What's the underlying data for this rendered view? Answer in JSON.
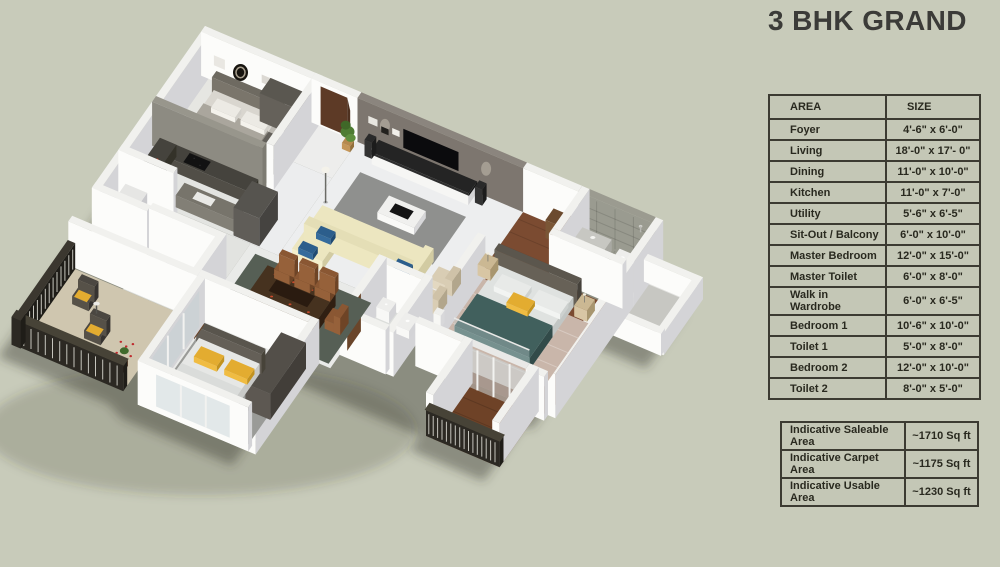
{
  "title": "3 BHK GRAND",
  "areas_table": {
    "headers": {
      "area": "AREA",
      "size": "SIZE"
    },
    "rows": [
      {
        "area": "Foyer",
        "size": "4'-6\" x 6'-0\""
      },
      {
        "area": "Living",
        "size": "18'-0\" x 17'- 0\""
      },
      {
        "area": "Dining",
        "size": "11'-0\" x 10'-0\""
      },
      {
        "area": "Kitchen",
        "size": "11'-0\" x 7'-0\""
      },
      {
        "area": "Utility",
        "size": "5'-6\" x 6'-5\""
      },
      {
        "area": "Sit-Out / Balcony",
        "size": "6'-0\" x 10'-0\""
      },
      {
        "area": "Master Bedroom",
        "size": "12'-0\" x 15'-0\""
      },
      {
        "area": "Master Toilet",
        "size": "6'-0\" x 8'-0\""
      },
      {
        "area": "Walk in Wardrobe",
        "size": "6'-0\" x 6'-5\""
      },
      {
        "area": "Bedroom 1",
        "size": "10'-6\" x 10'-0\""
      },
      {
        "area": "Toilet 1",
        "size": "5'-0\" x 8'-0\""
      },
      {
        "area": "Bedroom 2",
        "size": "12'-0\" x 10'-0\""
      },
      {
        "area": "Toilet 2",
        "size": "8'-0\" x 5'-0\""
      }
    ]
  },
  "summary_table": {
    "rows": [
      {
        "label": "Indicative Saleable Area",
        "value": "~1710 Sq ft"
      },
      {
        "label": "Indicative Carpet Area",
        "value": "~1175 Sq ft"
      },
      {
        "label": "Indicative Usable Area",
        "value": "~1230 Sq ft"
      }
    ]
  },
  "colors": {
    "background": "#c8cbba",
    "table_border": "#3c3b32",
    "text_dark": "#29291f",
    "wall_white": "#f1f1ee",
    "wall_shade": "#d4d4d7",
    "accent_wall": "#7d766f",
    "wood_floor": "#7b4b31",
    "tile_gray": "#9a9b90",
    "master_teal": "#41605d",
    "accent_yellow": "#e3ac30",
    "sofa_cream": "#ece6c0",
    "railing_dark": "#2c2923",
    "dining_wood": "#46321f"
  }
}
